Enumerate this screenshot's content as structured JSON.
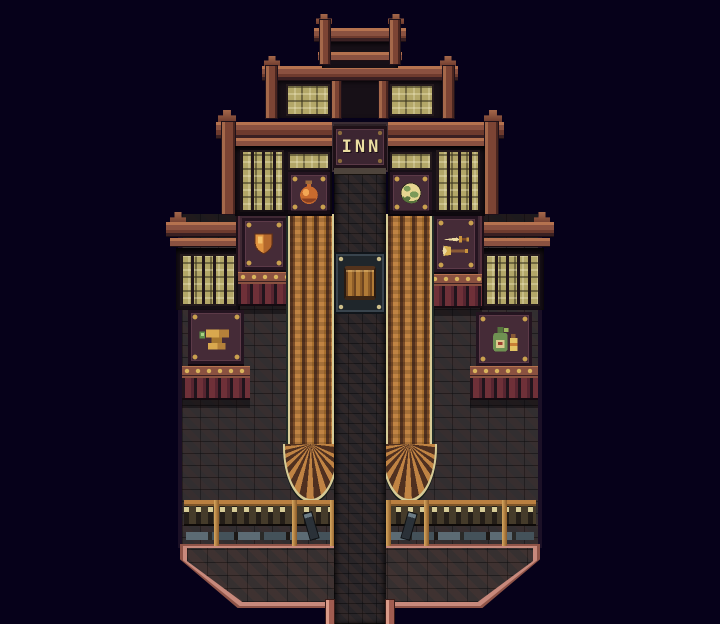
{
  "scene": {
    "type": "game-screenshot",
    "style": "16-bit pixel-art top-down RPG town at night",
    "description": "Tiered wooden shop arcade building with INN sign, six shop signboards, striped awnings with fan ends, central stone walkway, barrel stall, fence row and chamfered stone terrace",
    "background_color": "#06011a"
  },
  "inn_sign": {
    "label": "INN"
  },
  "shop_signs": [
    {
      "id": "item-shop",
      "icon": "potion-flask-icon",
      "position": "left of walkway, third tier"
    },
    {
      "id": "relic-shop",
      "icon": "crystal-orb-icon",
      "position": "right of walkway, third tier"
    },
    {
      "id": "armor-shop",
      "icon": "shield-icon",
      "position": "mid-left, fourth tier"
    },
    {
      "id": "weapon-shop",
      "icon": "sword-and-axe-icon",
      "position": "mid-right, fourth tier"
    },
    {
      "id": "smithy",
      "icon": "anvil-icon",
      "position": "lower-left, fourth tier"
    },
    {
      "id": "potion-shop",
      "icon": "bottles-icon",
      "position": "lower-right, fourth tier"
    }
  ],
  "objects": [
    {
      "id": "barrel-stall",
      "description": "wooden barrel on studded stand in walkway"
    },
    {
      "id": "awnings",
      "description": "two orange striped awnings with curved fan ends"
    },
    {
      "id": "fence-row",
      "description": "picket fence with cream caps along terrace"
    },
    {
      "id": "stone-terrace",
      "description": "chamfered stone platform with pink trim"
    }
  ],
  "palette": {
    "bg": "#06011a",
    "wood": "#8a5140",
    "woodlight": "#b5724f",
    "edgecream": "#d6cb96",
    "glass": "#b3a768",
    "stone": "#2f282c",
    "pathstone": "#262025",
    "signbg": "#452b37",
    "signborder": "#241420",
    "stud": "#c9a04e",
    "fencebg": "#3f3526",
    "fencecap": "#d6cb96",
    "pink": "#c8897c",
    "pinkdark": "#8f5448",
    "inntext": "#ecdfa2"
  }
}
